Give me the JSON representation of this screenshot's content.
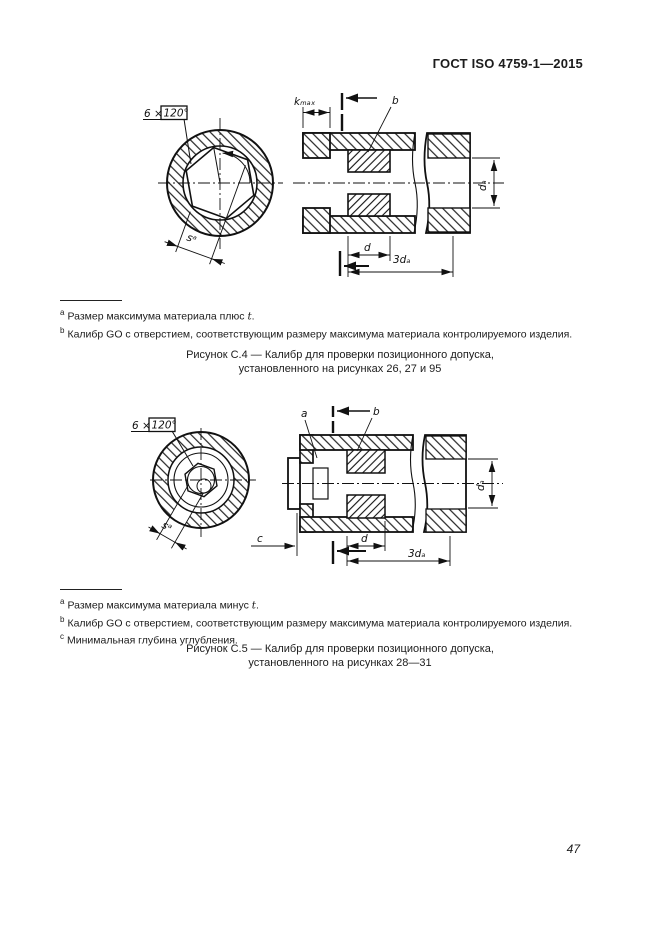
{
  "page": {
    "header": "ГОСТ ISO 4759-1—2015",
    "page_number": "47"
  },
  "figure_c4": {
    "labels": {
      "six_times": "6 ×",
      "angle_boxed": "120°",
      "s": "sᵃ",
      "kmax": "kₘₐₓ",
      "b": "b",
      "d": "d",
      "d_a": "dₐ",
      "three_d_a": "3dₐ"
    },
    "footnotes": [
      {
        "marker": "a",
        "pre": "Размер максимума материала плюс ",
        "var": "t",
        "post": "."
      },
      {
        "marker": "b",
        "pre": "Калибр GO с отверстием, соответствующим размеру максимума материала контролируемого изделия.",
        "var": "",
        "post": ""
      }
    ],
    "caption_line1": "Рисунок С.4 — Калибр для проверки позиционного допуска,",
    "caption_line2": "установленного на рисунках 26, 27 и 95"
  },
  "figure_c5": {
    "labels": {
      "six_times": "6 ×",
      "angle_boxed": "120°",
      "s": "sᵃ",
      "a": "a",
      "b": "b",
      "c": "c",
      "d": "d",
      "d_a": "dₐ",
      "three_d_a": "3dₐ"
    },
    "footnotes": [
      {
        "marker": "a",
        "pre": "Размер максимума материала минус ",
        "var": "t",
        "post": "."
      },
      {
        "marker": "b",
        "pre": "Калибр GO с отверстием, соответствующим размеру максимума материала контролируемого изделия.",
        "var": "",
        "post": ""
      },
      {
        "marker": "c",
        "pre": "Минимальная глубина углубления.",
        "var": "",
        "post": ""
      }
    ],
    "caption_line1": "Рисунок С.5 — Калибр для проверки позиционного допуска,",
    "caption_line2": "установленного на рисунках 28—31"
  }
}
